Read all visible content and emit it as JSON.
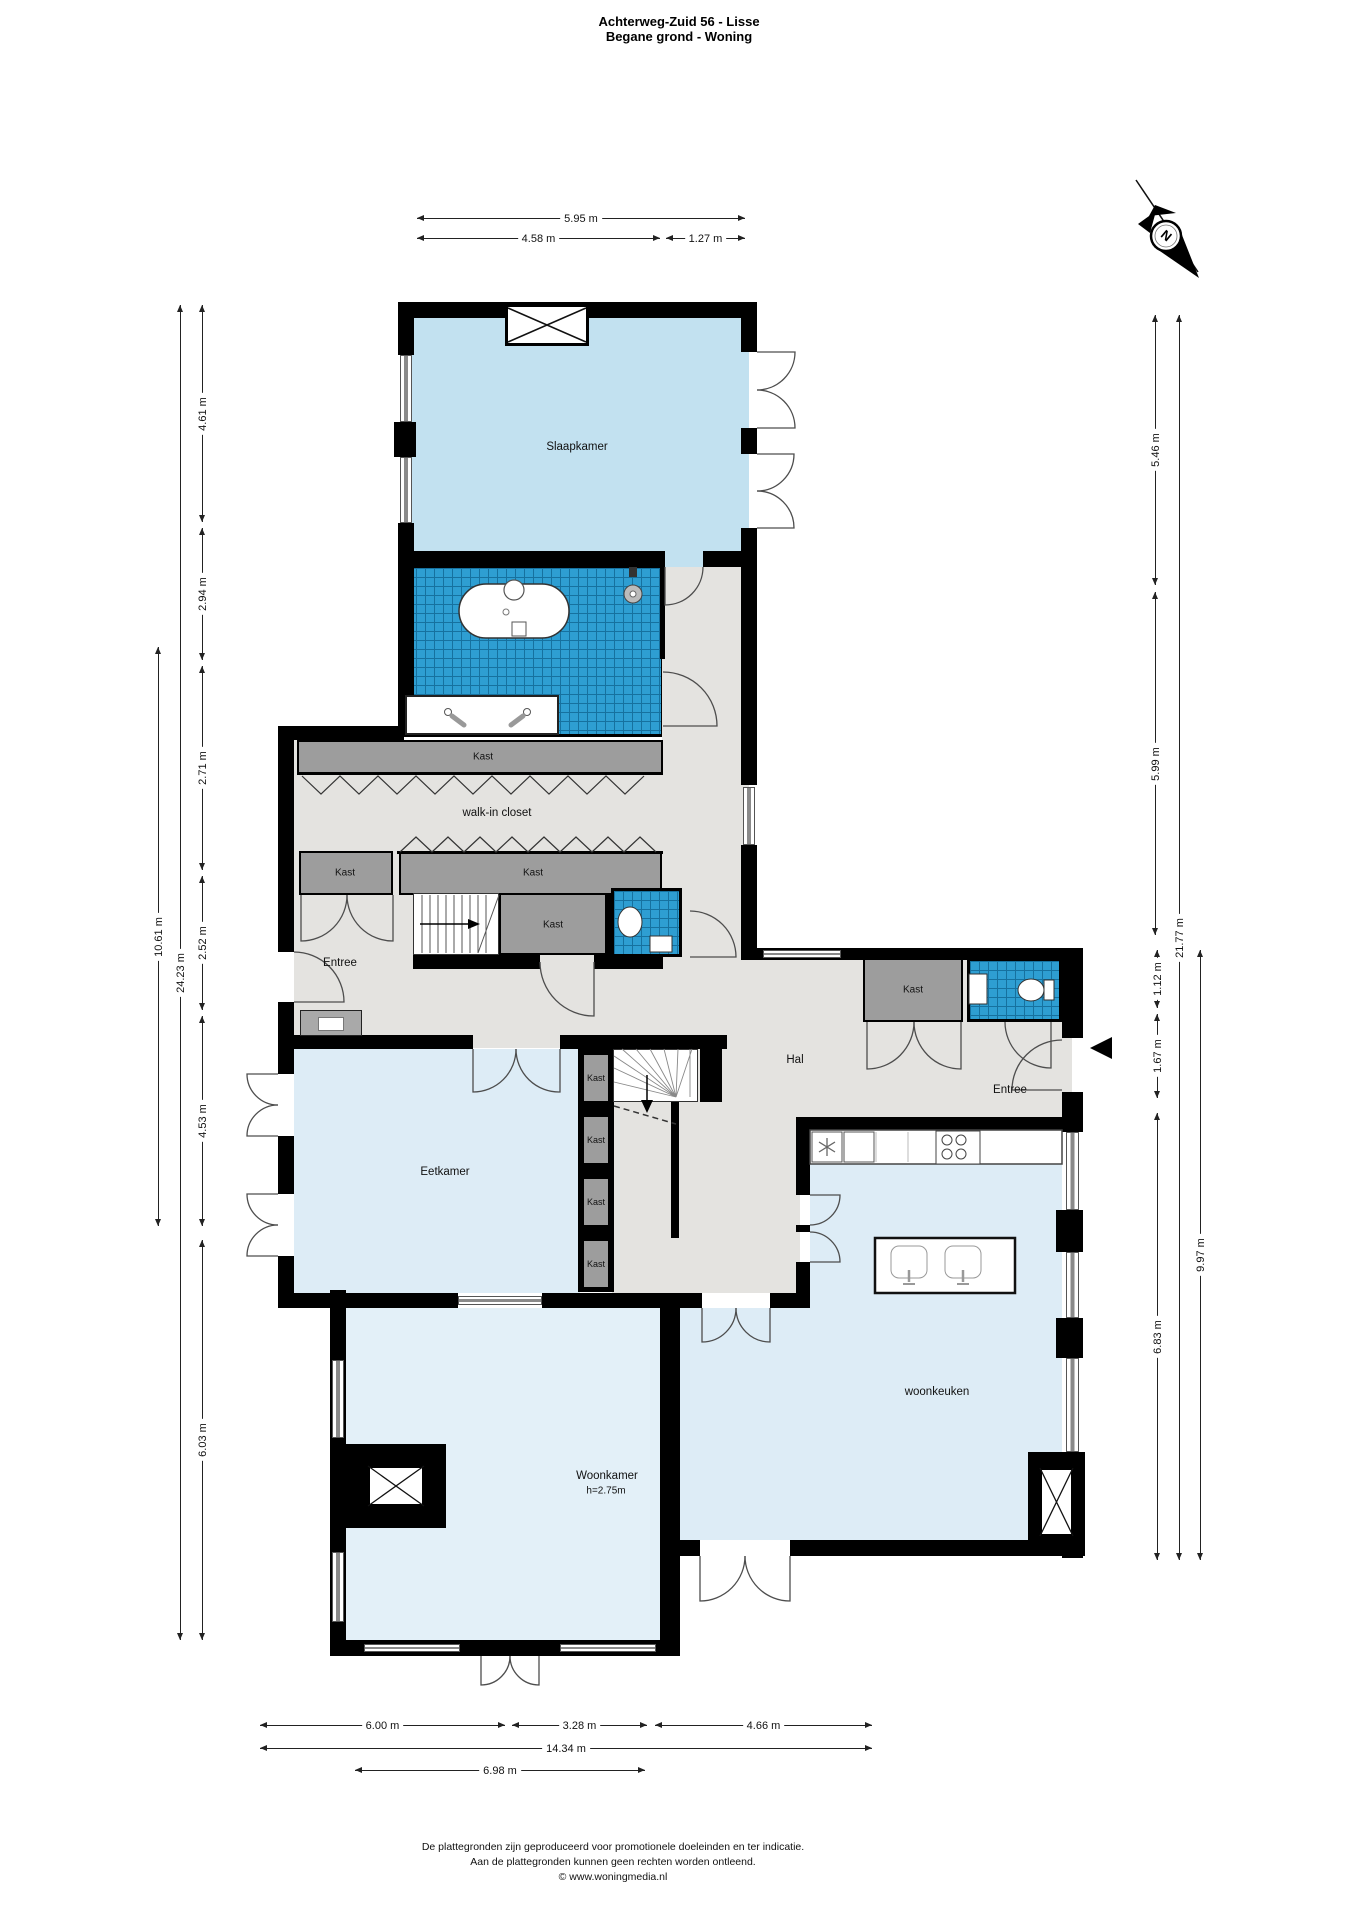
{
  "title": {
    "line1": "Achterweg-Zuid 56 - Lisse",
    "line2": "Begane grond - Woning"
  },
  "compass": {
    "north_letter": "N"
  },
  "labels": {
    "slaapkamer": "Slaapkamer",
    "kast": "Kast",
    "walk_in_closet": "walk-in closet",
    "entree": "Entree",
    "hal": "Hal",
    "eetkamer": "Eetkamer",
    "woonkamer": "Woonkamer",
    "woonkamer_height": "h=2.75m",
    "woonkeuken": "woonkeuken"
  },
  "dimensions": {
    "top": [
      "5.95 m",
      "4.58 m",
      "1.27 m"
    ],
    "left": [
      "4.61 m",
      "2.94 m",
      "2.71 m",
      "2.52 m",
      "4.53 m",
      "6.03 m"
    ],
    "left_totals": [
      "24.23 m",
      "10.61 m"
    ],
    "right": [
      "5.46 m",
      "5.99 m",
      "1.12 m",
      "1.67 m",
      "6.83 m"
    ],
    "right_totals": [
      "21.77 m",
      "9.97 m"
    ],
    "bottom": [
      "6.00 m",
      "3.28 m",
      "4.66 m"
    ],
    "bottom_totals": [
      "14.34 m",
      "6.98 m"
    ]
  },
  "footer": {
    "line1": "De plattegronden zijn geproduceerd voor promotionele doeleinden en ter indicatie.",
    "line2": "Aan de plattegronden kunnen geen rechten worden ontleend.",
    "line3": "© www.woningmedia.nl"
  }
}
